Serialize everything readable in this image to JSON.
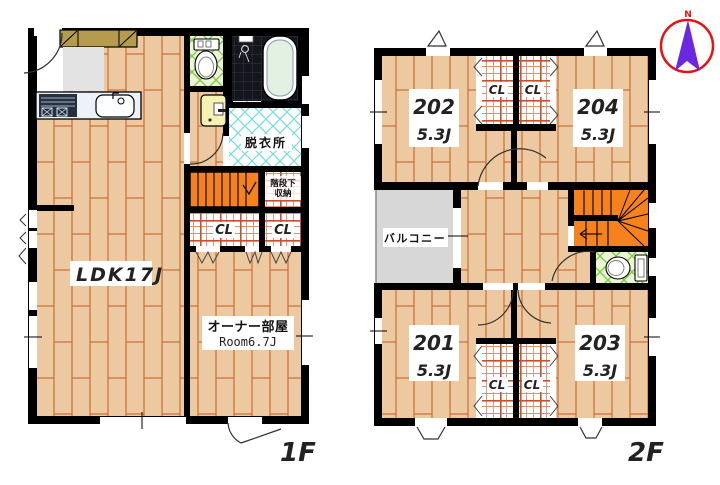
{
  "plan": {
    "floor1": {
      "label": "1F",
      "ldk_label": "LDK17J",
      "owner_room": {
        "name": "オーナー部屋",
        "size": "Room6.7J"
      },
      "dressing_room": "脱衣所",
      "under_stair_storage": [
        "階段下",
        "収納"
      ],
      "closets": [
        "CL",
        "CL"
      ]
    },
    "floor2": {
      "label": "2F",
      "balcony": "バルコニー",
      "rooms": [
        {
          "number": "202",
          "size": "5.3J"
        },
        {
          "number": "204",
          "size": "5.3J"
        },
        {
          "number": "201",
          "size": "5.3J"
        },
        {
          "number": "203",
          "size": "5.3J"
        }
      ],
      "closets": [
        "CL",
        "CL",
        "CL",
        "CL"
      ]
    },
    "compass": {
      "north": "N"
    },
    "colors": {
      "wall": "#000000",
      "wood_floor": "#edc9a1",
      "wood_plank_line": "#c2601f",
      "stairs": "#f5821c",
      "balcony": "#d7d7d7",
      "tile_green_line": "#7cc944",
      "tile_cyan_line": "#74d9da",
      "closet_plaid_line": "#c9502e",
      "bath_dark": "#15161c",
      "cabinet": "#b49b4d",
      "compass_ring": "#e81111",
      "compass_needle": "#6b28e0"
    }
  }
}
